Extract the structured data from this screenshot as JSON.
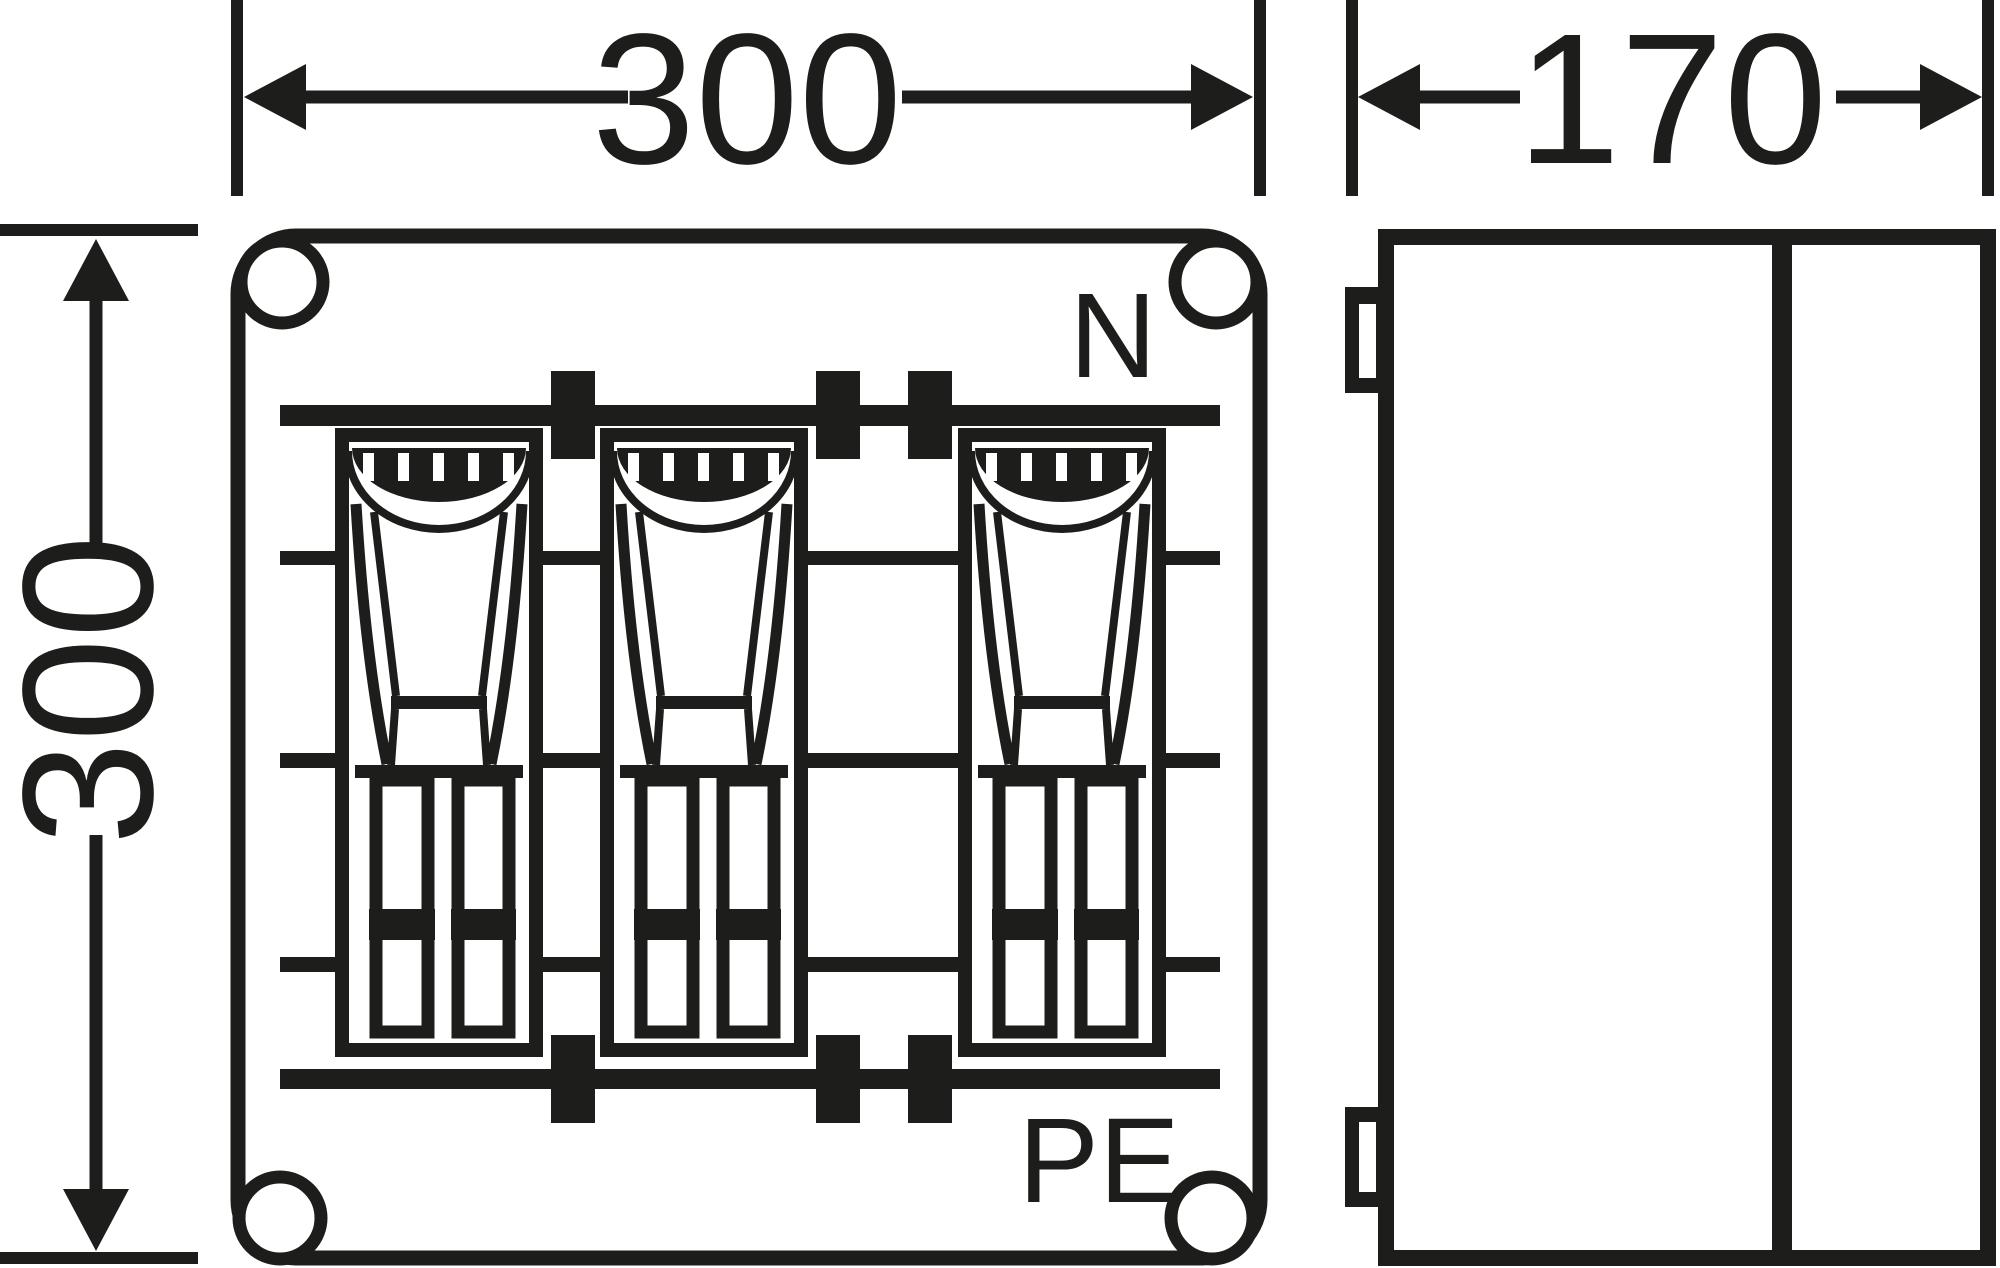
{
  "drawing": {
    "type": "enclosure-dimension-drawing",
    "ink_color": "#1d1d1b",
    "background_color": "#ffffff",
    "front_view": {
      "width_label": "300",
      "height_label": "300",
      "neutral_label": "N",
      "pe_label": "PE",
      "fuse_switch_units": 3,
      "mounting_holes": 4,
      "busbar_clamps": 6,
      "terminal_rails": 3
    },
    "side_view": {
      "depth_label": "170",
      "mounting_lugs": 2,
      "cover_sections": 2
    }
  }
}
